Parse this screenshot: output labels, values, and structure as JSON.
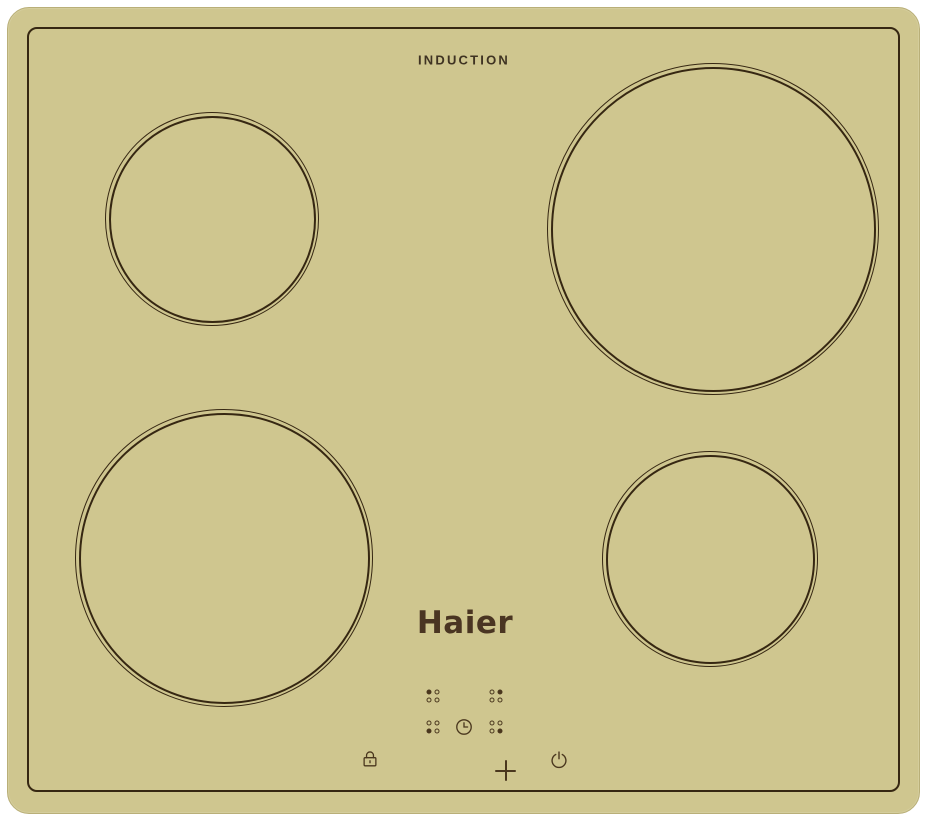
{
  "cooktop": {
    "type_label": "INDUCTION",
    "brand": "Haier",
    "colors": {
      "glass": "#cfc68f",
      "line": "#362712",
      "icon": "#4a371e",
      "logo_text": "#4a3522",
      "background": "#ffffff"
    },
    "zones": [
      {
        "position": "back-left",
        "size": "medium"
      },
      {
        "position": "back-right",
        "size": "large"
      },
      {
        "position": "front-left",
        "size": "large"
      },
      {
        "position": "front-right",
        "size": "medium"
      }
    ],
    "controls": {
      "zone_keys": [
        {
          "zone": "back-left",
          "filled_dot": "top-left"
        },
        {
          "zone": "back-right",
          "filled_dot": "top-right"
        },
        {
          "zone": "front-left",
          "filled_dot": "bottom-left"
        },
        {
          "zone": "front-right",
          "filled_dot": "bottom-right"
        }
      ],
      "timer_icon": "clock-icon",
      "lock_icon": "padlock-icon",
      "decrease_icon": "minus-icon",
      "increase_icon": "plus-icon",
      "power_icon": "power-icon"
    }
  }
}
